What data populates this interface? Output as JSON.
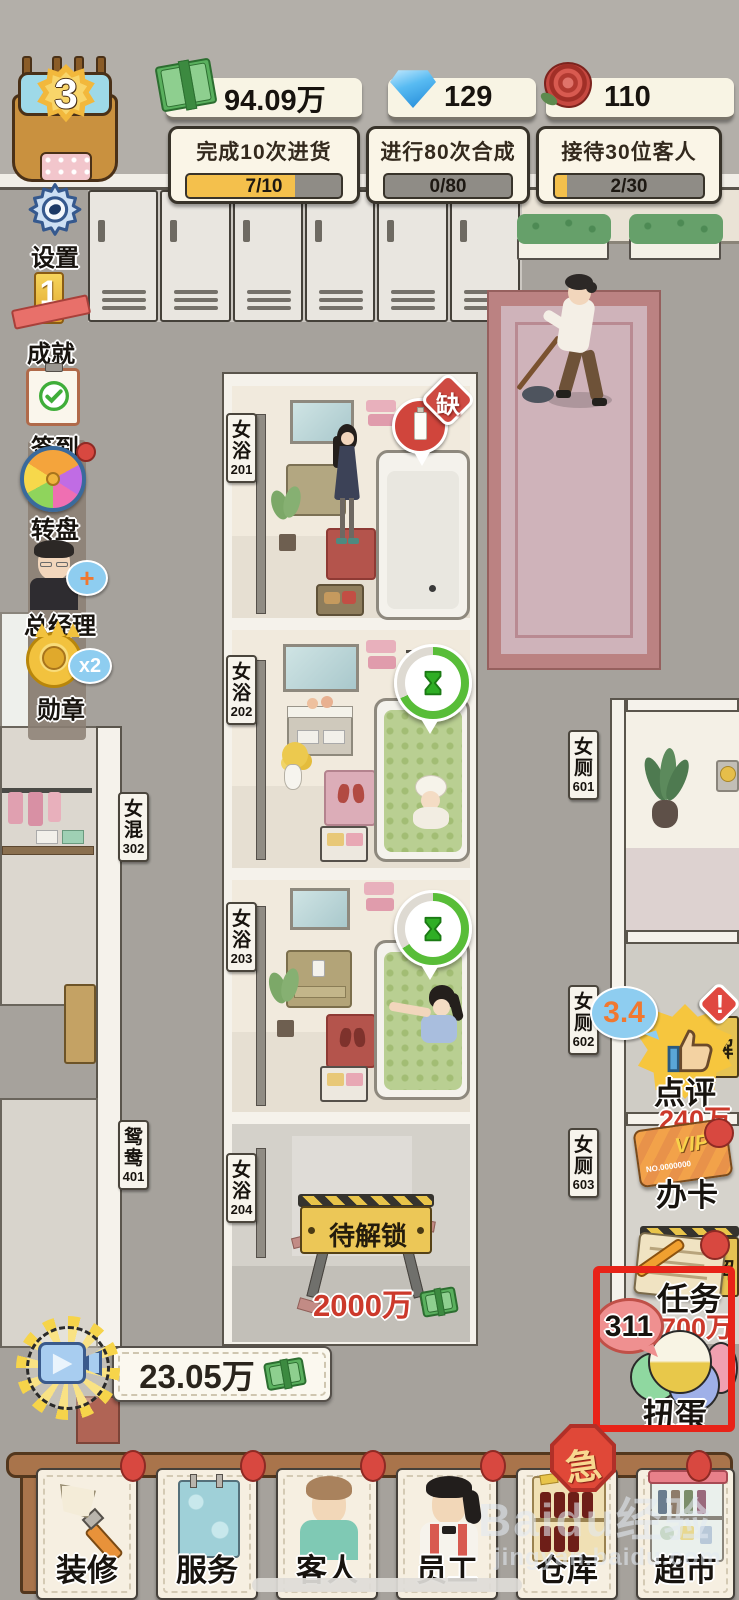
{
  "hud": {
    "level": "3",
    "currencies": [
      {
        "id": "cash",
        "value": "94.09万"
      },
      {
        "id": "diamond",
        "value": "129"
      },
      {
        "id": "rose",
        "value": "110"
      }
    ],
    "quests": [
      {
        "title": "完成10次进货",
        "progress": "7/10"
      },
      {
        "title": "进行80次合成",
        "progress": "0/80"
      },
      {
        "title": "接待30位客人",
        "progress": "2/30"
      }
    ]
  },
  "sidebar": {
    "items": [
      {
        "label": "设置"
      },
      {
        "label": "成就",
        "icon_glyph": "1"
      },
      {
        "label": "签到"
      },
      {
        "label": "转盘"
      },
      {
        "label": "总经理",
        "bubble": "+"
      },
      {
        "label": "勋章",
        "bubble": "x2"
      }
    ]
  },
  "world": {
    "room_labels": [
      {
        "c1": "女",
        "c2": "浴",
        "num": "201"
      },
      {
        "c1": "女",
        "c2": "浴",
        "num": "202"
      },
      {
        "c1": "女",
        "c2": "浴",
        "num": "203"
      },
      {
        "c1": "女",
        "c2": "浴",
        "num": "204"
      },
      {
        "c1": "女",
        "c2": "混",
        "num": "302"
      },
      {
        "c1": "鸳",
        "c2": "鸯",
        "num": "401"
      },
      {
        "c1": "女",
        "c2": "厕",
        "num": "601"
      },
      {
        "c1": "女",
        "c2": "厕",
        "num": "602"
      },
      {
        "c1": "女",
        "c2": "厕",
        "num": "603"
      }
    ],
    "shortage_badge": "缺",
    "locked_sign": "待解锁",
    "locked_price": "2000万"
  },
  "right_panel": {
    "review": {
      "label": "点评",
      "rating": "3.4",
      "alert": "!",
      "price": "240万",
      "unlock_tag": "解"
    },
    "vip": {
      "label": "办卡",
      "brand": "VIP",
      "card_no": "NO.0000000"
    },
    "task": {
      "label": "任务",
      "price": "700万",
      "unlock_tag": "解"
    },
    "gacha": {
      "label": "扭蛋",
      "count": "311"
    }
  },
  "footer": {
    "reward_value": "23.05万",
    "urgent": "急",
    "nav": [
      {
        "label": "装修"
      },
      {
        "label": "服务"
      },
      {
        "label": "客人"
      },
      {
        "label": "员工"
      },
      {
        "label": "仓库"
      },
      {
        "label": "超市"
      }
    ]
  },
  "watermark": {
    "brand": "Baidu经验",
    "url": "jingyan.baidu.com"
  },
  "colors": {
    "accent_red": "#d6453a",
    "gold": "#f3c24d",
    "bubble_blue": "#8ecdf0",
    "money_green": "#58b25c",
    "highlight_red": "#e42620"
  }
}
